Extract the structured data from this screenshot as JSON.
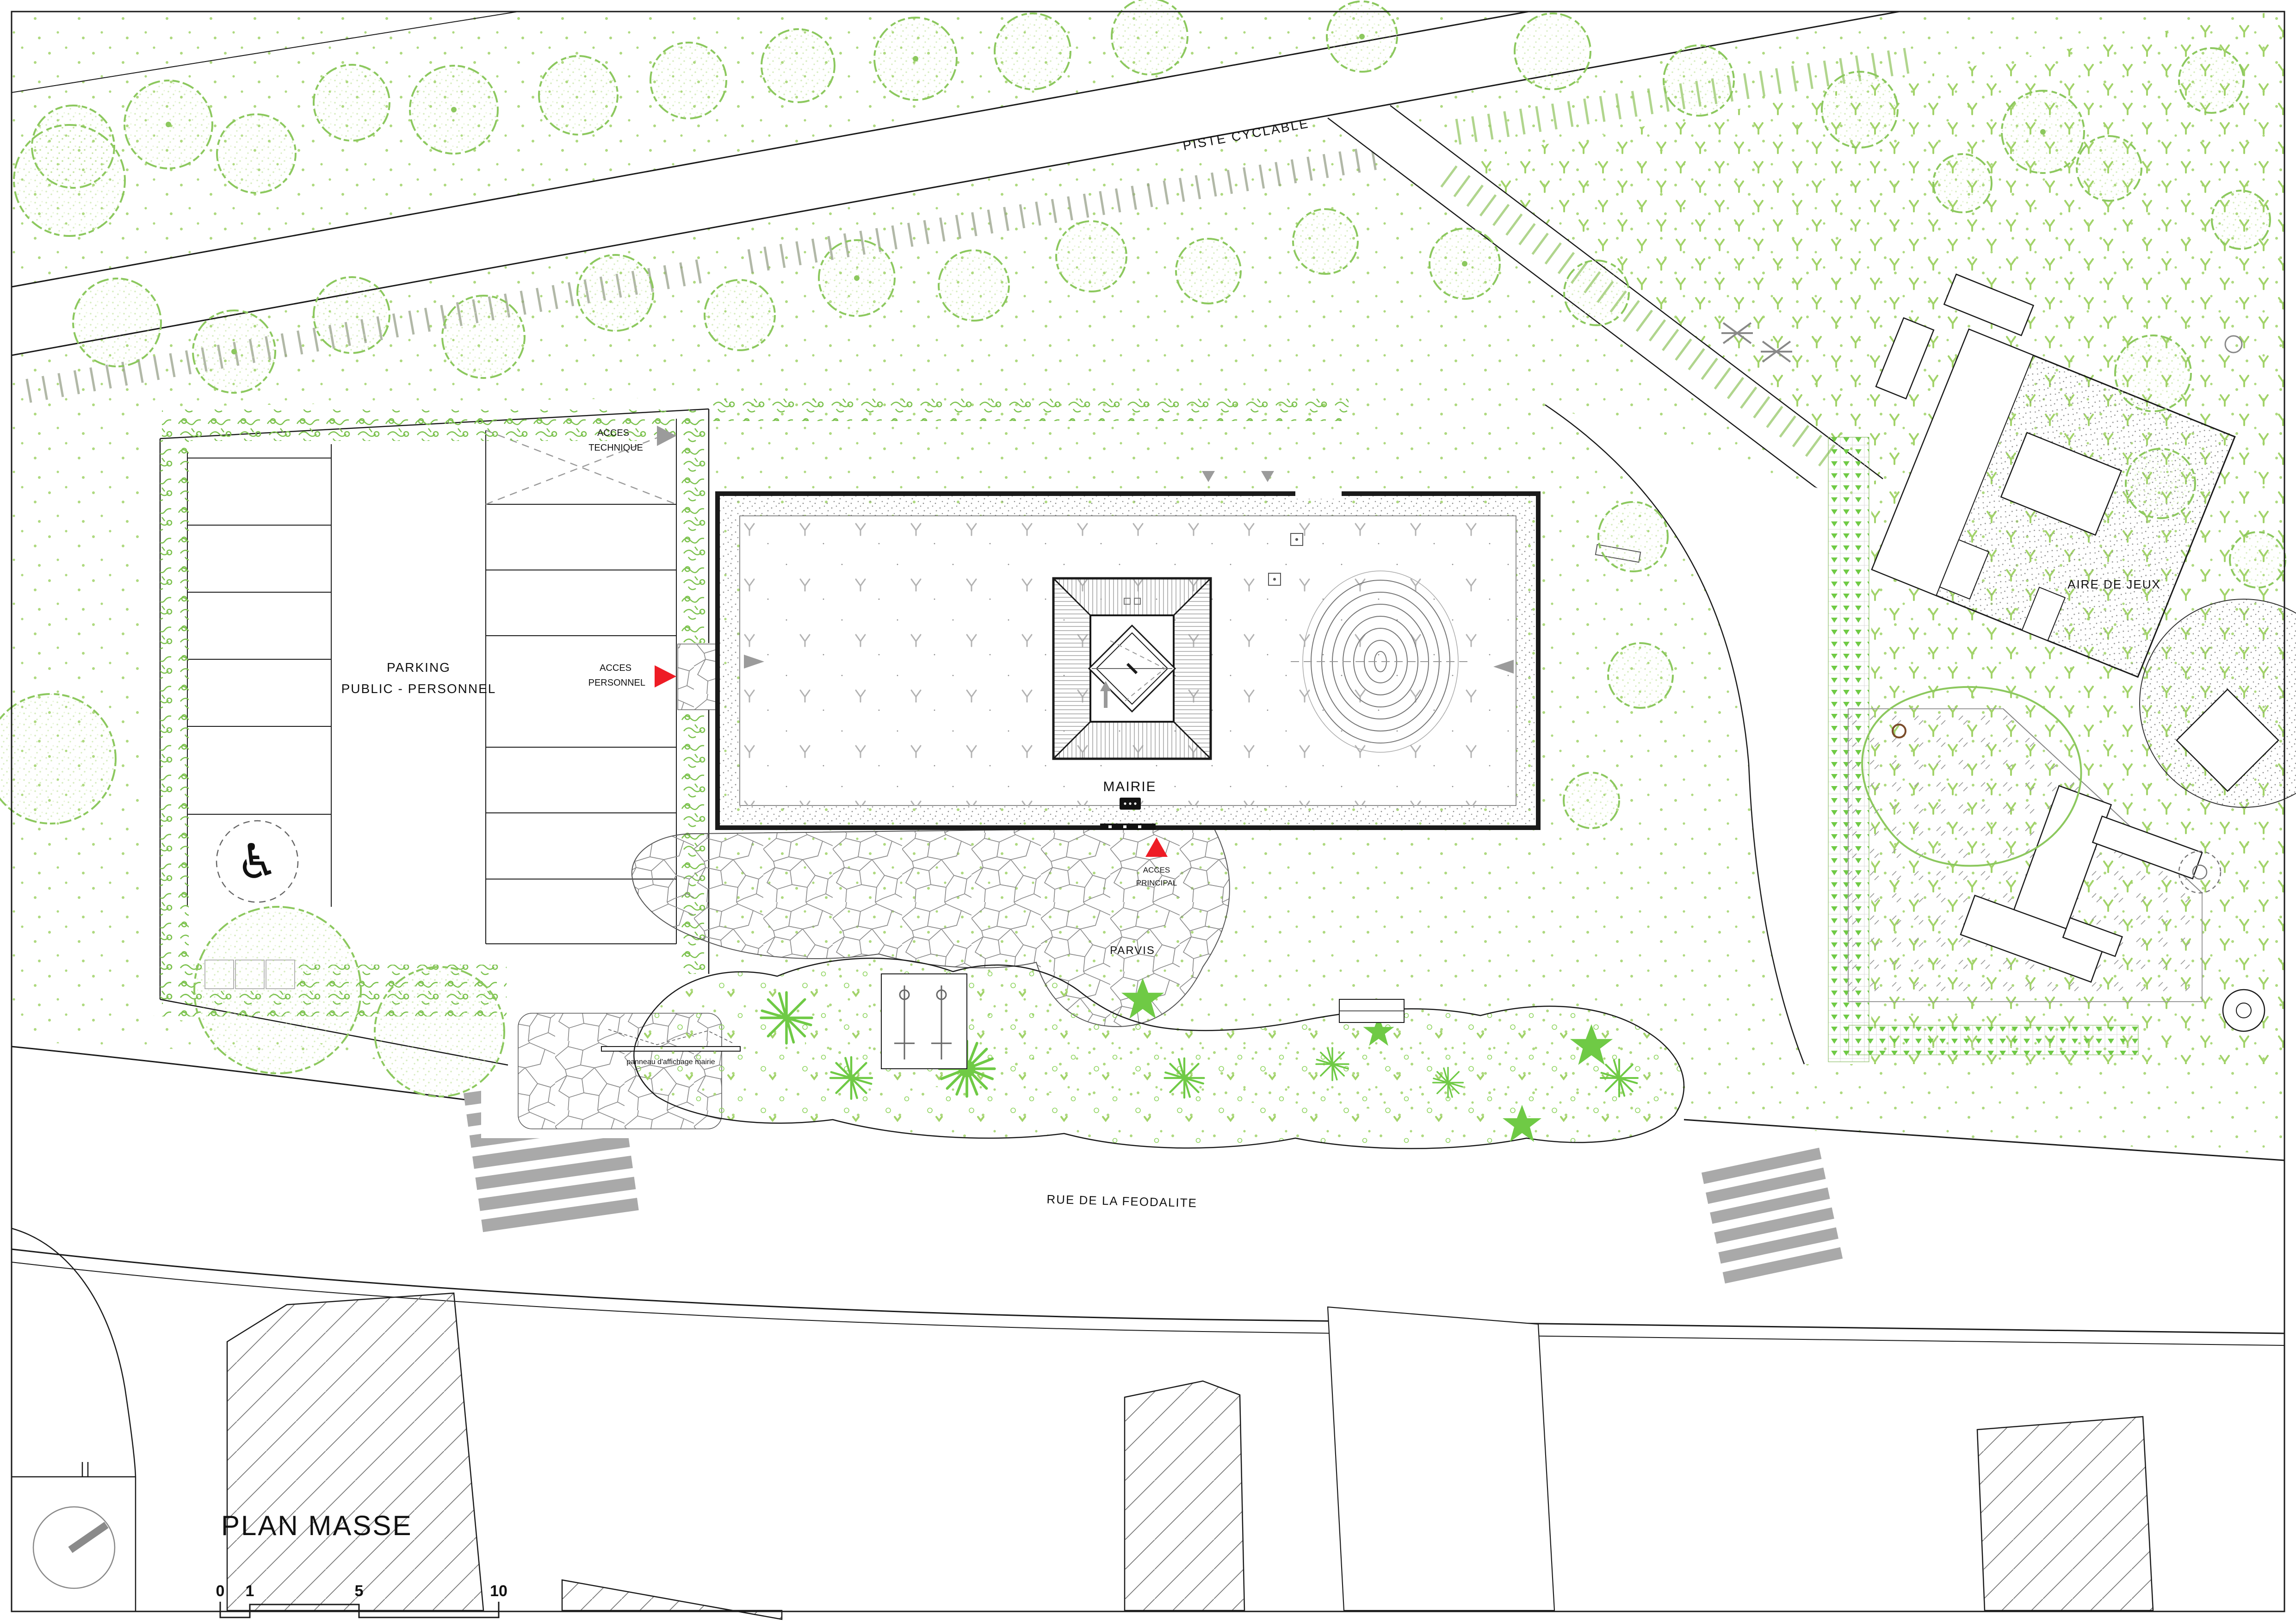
{
  "title": "PLAN MASSE",
  "labels": {
    "piste_cyclable": "PISTE CYCLABLE",
    "parking_line1": "PARKING",
    "parking_line2": "PUBLIC - PERSONNEL",
    "acces_technique_line1": "ACCES",
    "acces_technique_line2": "TECHNIQUE",
    "acces_personnel_line1": "ACCES",
    "acces_personnel_line2": "PERSONNEL",
    "acces_principal_line1": "ACCES",
    "acces_principal_line2": "PRINCIPAL",
    "mairie": "MAIRIE",
    "parvis": "PARVIS",
    "aire_de_jeux": "AIRE DE JEUX",
    "rue": "RUE DE LA FEODALITE",
    "panneau_affichage": "panneau d'affichage mairie"
  },
  "scale_bar": {
    "ticks": [
      "0",
      "1",
      "5",
      "10"
    ]
  },
  "colors": {
    "tree_green": "#8cc85e",
    "dot_green": "#aed97f",
    "lawn_green": "#a2d36a",
    "hedge_green": "#7cc24e",
    "plant_green": "#6fca45",
    "accent_red": "#ee1c25",
    "gray": "#9b9b9b",
    "line_black": "#1a1a1a"
  }
}
